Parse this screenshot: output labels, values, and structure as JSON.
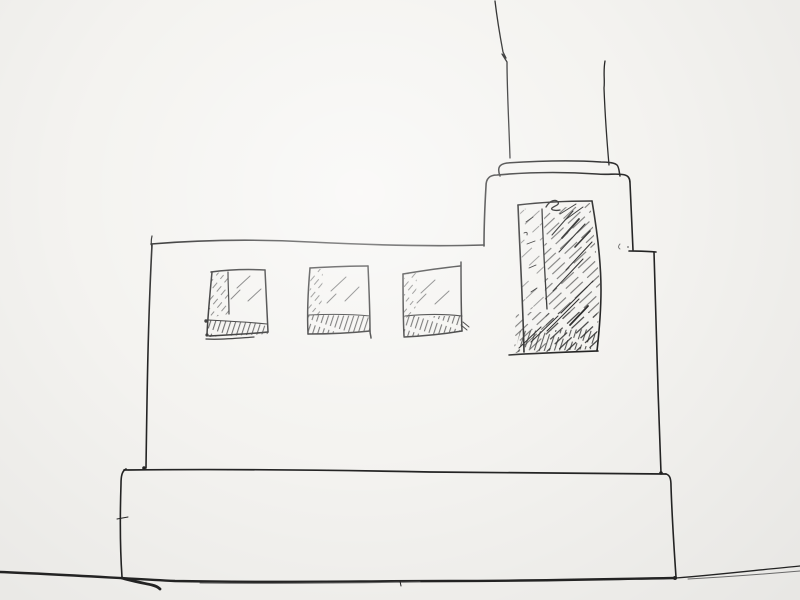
{
  "meta": {
    "type": "hand-drawn ink sketch on paper",
    "subject": "Pen sketch of a flat-roofed industrial building with a tall chimney, a raised tower with one large hatched window, three small hatched windows, a stepped plinth base and a ground line"
  },
  "colors": {
    "paper": "#f4f3f0",
    "ink": "#242424",
    "ink_light": "#6d6d6d"
  },
  "scene": {
    "parts": [
      "ground-line",
      "base-plinth",
      "building-body",
      "tower",
      "chimney-cap",
      "chimney",
      "tower-window",
      "window-1",
      "window-2",
      "window-3"
    ],
    "window_count": 4,
    "text_content": ""
  }
}
